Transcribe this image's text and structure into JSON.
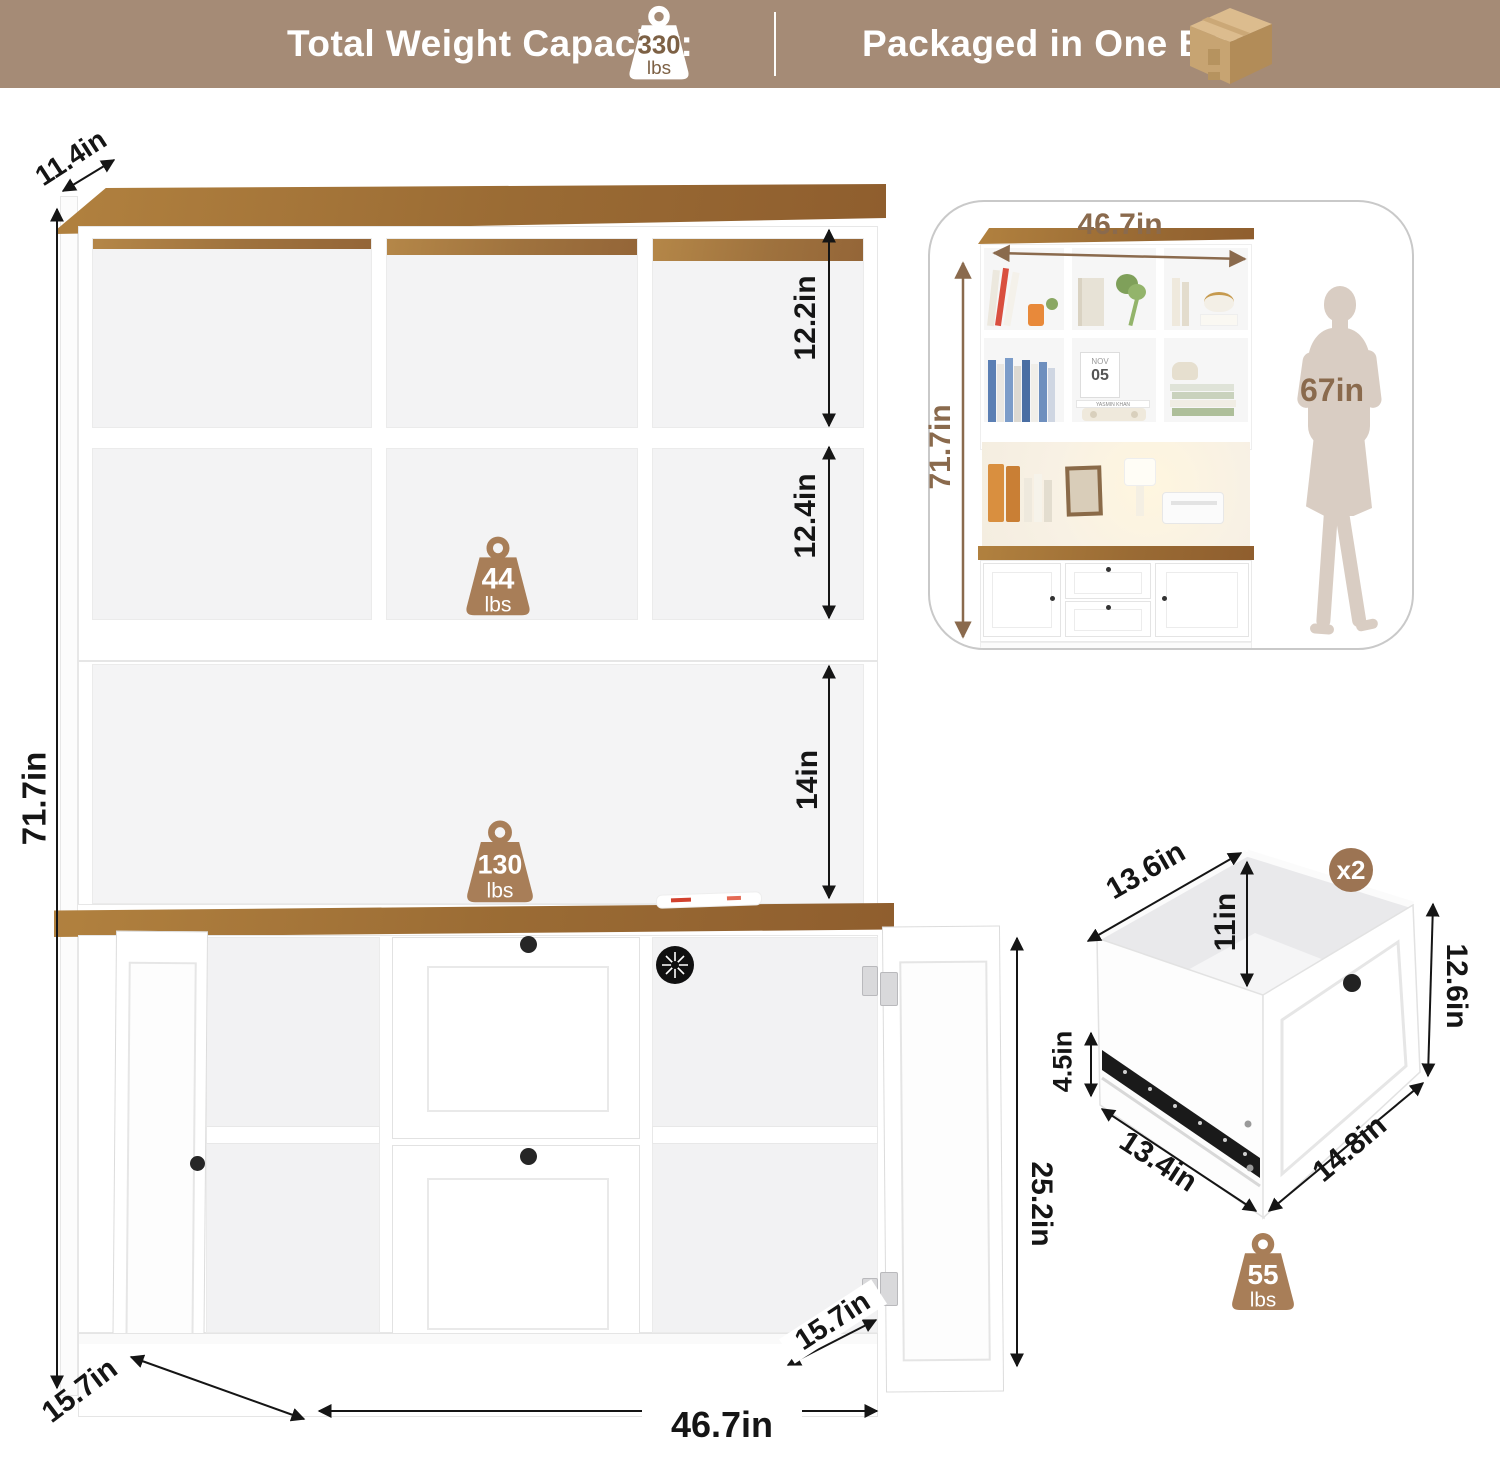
{
  "banner": {
    "left_label": "Total Weight Capacity:",
    "capacity_value": "330",
    "capacity_unit": "lbs",
    "right_label": "Packaged in One Box"
  },
  "main_diagram": {
    "top_depth": "11.4in",
    "total_height": "71.7in",
    "cubby_top_height": "12.2in",
    "cubby_mid_height": "12.4in",
    "open_shelf_height": "14in",
    "hutch_capacity_value": "44",
    "hutch_capacity_unit": "lbs",
    "counter_capacity_value": "130",
    "counter_capacity_unit": "lbs",
    "door_opening_height": "25.2in",
    "door_depth": "15.7in",
    "base_depth": "15.7in",
    "total_width": "46.7in"
  },
  "scale_card": {
    "width": "46.7in",
    "height": "71.7in",
    "person_height": "67in",
    "calendar_month": "NOV",
    "calendar_day": "05",
    "book_title": "YASMIN KHAN"
  },
  "drawer_diagram": {
    "top_depth": "13.6in",
    "inner_height": "11in",
    "quantity_badge": "x2",
    "front_height": "12.6in",
    "rail_height": "4.5in",
    "bottom_depth": "13.4in",
    "front_width": "14.8in",
    "capacity_value": "55",
    "capacity_unit": "lbs"
  },
  "colors": {
    "banner_bg": "#a58b76",
    "icon_brown": "#a87e58",
    "badge_brown": "#9c7453",
    "text_brown": "#8a6a4d",
    "wood_dark": "#8f5e2e",
    "wood_light": "#b1813f",
    "silhouette": "#d9cdc3"
  }
}
